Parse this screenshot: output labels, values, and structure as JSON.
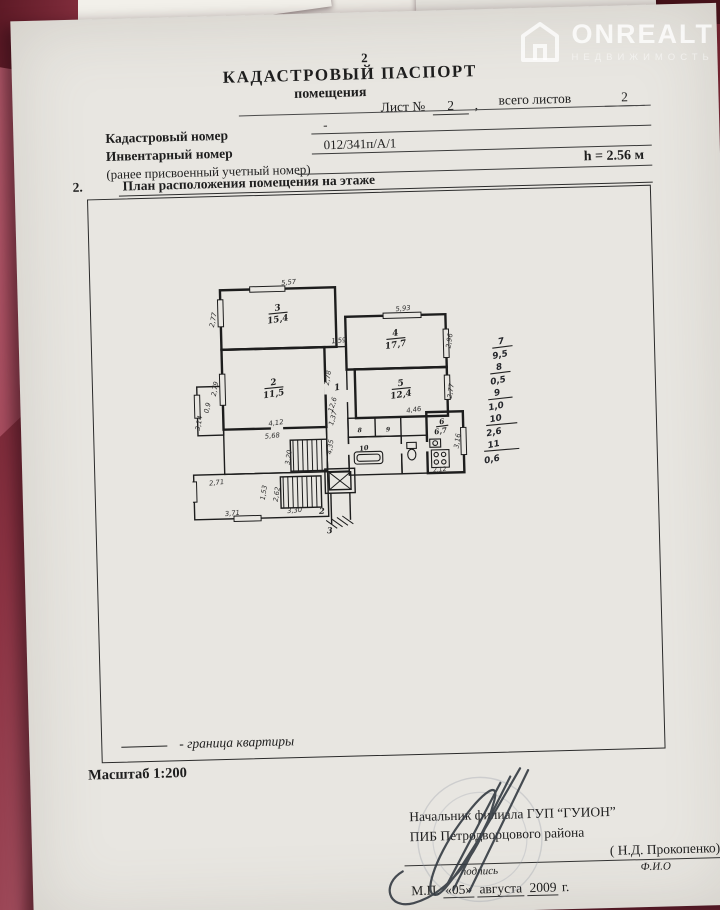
{
  "colors": {
    "background_maroon": "#7c2935",
    "folder_pink": "#a44a5c",
    "paper": "#e8e6e1",
    "ink": "#1e1e1e",
    "watermark_white": "rgba(255,255,255,0.78)"
  },
  "watermark": {
    "brand": "ONREALT",
    "subtitle": "НЕДВИЖИМОСТЬ"
  },
  "header": {
    "page_number": "2",
    "title": "КАДАСТРОВЫЙ ПАСПОРТ",
    "subtitle": "помещения",
    "sheet_label": "Лист №",
    "sheet_value": "2",
    "comma": ",",
    "total_label": "всего листов",
    "total_value": "2"
  },
  "fields": {
    "cadastral_label": "Кадастровый номер",
    "cadastral_value": "-",
    "inventory_label": "Инвентарный номер",
    "inventory_value": "012/341п/А/1",
    "former_label": "(ранее присвоенный учетный номер)",
    "height_value": "h = 2.56 м"
  },
  "section": {
    "number": "2.",
    "title": "План расположения помещения на этаже"
  },
  "plan": {
    "labels": [
      {
        "t": "3",
        "x": 133,
        "y": 50,
        "r": -8,
        "s": 13,
        "c": "room"
      },
      {
        "t": "15,4",
        "x": 133,
        "y": 67,
        "r": -8,
        "s": 13,
        "c": "room"
      },
      {
        "t": "2",
        "x": 124,
        "y": 160,
        "r": -8,
        "s": 13,
        "c": "room"
      },
      {
        "t": "11,5",
        "x": 124,
        "y": 177,
        "r": -8,
        "s": 13,
        "c": "room"
      },
      {
        "t": "4",
        "x": 306,
        "y": 92,
        "r": -8,
        "s": 13,
        "c": "room"
      },
      {
        "t": "17,7",
        "x": 306,
        "y": 109,
        "r": -8,
        "s": 13,
        "c": "room"
      },
      {
        "t": "5",
        "x": 312,
        "y": 166,
        "r": -8,
        "s": 13,
        "c": "room"
      },
      {
        "t": "12,4",
        "x": 312,
        "y": 183,
        "r": -8,
        "s": 13,
        "c": "room"
      },
      {
        "t": "1",
        "x": 218,
        "y": 170,
        "r": -8,
        "s": 13,
        "c": "room"
      },
      {
        "t": "6",
        "x": 371,
        "y": 224,
        "r": -8,
        "s": 11,
        "c": "room"
      },
      {
        "t": "6,7",
        "x": 369,
        "y": 238,
        "r": -8,
        "s": 11,
        "c": "room"
      },
      {
        "t": "8",
        "x": 249,
        "y": 233,
        "r": 0,
        "s": 9,
        "c": "room"
      },
      {
        "t": "9",
        "x": 291,
        "y": 233,
        "r": 0,
        "s": 9,
        "c": "room"
      },
      {
        "t": "10",
        "x": 255,
        "y": 260,
        "r": -8,
        "s": 10,
        "c": "room"
      },
      {
        "t": "2",
        "x": 190,
        "y": 352,
        "r": 0,
        "s": 12,
        "c": "room"
      },
      {
        "t": "3",
        "x": 201,
        "y": 381,
        "r": 0,
        "s": 12,
        "c": "room"
      },
      {
        "t": "5,57",
        "x": 150,
        "y": 12,
        "r": -4,
        "s": 10,
        "c": "dim"
      },
      {
        "t": "2,77",
        "x": 40,
        "y": 62,
        "r": -78,
        "s": 10,
        "c": "dim"
      },
      {
        "t": "2,79",
        "x": 40,
        "y": 164,
        "r": -78,
        "s": 10,
        "c": "dim"
      },
      {
        "t": "4,12",
        "x": 126,
        "y": 219,
        "r": -6,
        "s": 10,
        "c": "dim"
      },
      {
        "t": "1,59",
        "x": 222,
        "y": 100,
        "r": -4,
        "s": 10,
        "c": "dim"
      },
      {
        "t": "2,78",
        "x": 207,
        "y": 152,
        "r": -80,
        "s": 10,
        "c": "dim"
      },
      {
        "t": "5,93",
        "x": 318,
        "y": 55,
        "r": -4,
        "s": 10,
        "c": "dim"
      },
      {
        "t": "2,96",
        "x": 388,
        "y": 102,
        "r": -80,
        "s": 10,
        "c": "dim"
      },
      {
        "t": "4,46",
        "x": 330,
        "y": 205,
        "r": -6,
        "s": 10,
        "c": "dim"
      },
      {
        "t": "2,77",
        "x": 388,
        "y": 176,
        "r": -80,
        "s": 10,
        "c": "dim"
      },
      {
        "t": "12,6",
        "x": 213,
        "y": 192,
        "r": -72,
        "s": 10,
        "c": "dim"
      },
      {
        "t": "1,37",
        "x": 213,
        "y": 212,
        "r": -72,
        "s": 10,
        "c": "dim"
      },
      {
        "t": "4,35",
        "x": 208,
        "y": 254,
        "r": -80,
        "s": 10,
        "c": "dim"
      },
      {
        "t": "5,68",
        "x": 120,
        "y": 238,
        "r": -4,
        "s": 10,
        "c": "dim"
      },
      {
        "t": "3,20",
        "x": 146,
        "y": 268,
        "r": -80,
        "s": 10,
        "c": "dim"
      },
      {
        "t": "0,9",
        "x": 28,
        "y": 192,
        "r": -75,
        "s": 10,
        "c": "dim"
      },
      {
        "t": "3,14",
        "x": 15,
        "y": 214,
        "r": -78,
        "s": 10,
        "c": "dim"
      },
      {
        "t": "2,71",
        "x": 36,
        "y": 305,
        "r": -5,
        "s": 10,
        "c": "dim"
      },
      {
        "t": "1,53",
        "x": 108,
        "y": 319,
        "r": -80,
        "s": 10,
        "c": "dim"
      },
      {
        "t": "2,62",
        "x": 127,
        "y": 322,
        "r": -80,
        "s": 10,
        "c": "dim"
      },
      {
        "t": "3,71",
        "x": 58,
        "y": 351,
        "r": -4,
        "s": 10,
        "c": "dim"
      },
      {
        "t": "3,30",
        "x": 150,
        "y": 349,
        "r": -4,
        "s": 10,
        "c": "dim"
      },
      {
        "t": "2,12",
        "x": 366,
        "y": 294,
        "r": -5,
        "s": 9,
        "c": "dim"
      },
      {
        "t": "3,16",
        "x": 396,
        "y": 250,
        "r": -80,
        "s": 10,
        "c": "dim"
      },
      {
        "t": "7",
        "x": 462,
        "y": 108,
        "r": -10,
        "s": 13,
        "c": "hand"
      },
      {
        "t": "9,5",
        "x": 460,
        "y": 128,
        "r": -10,
        "s": 13,
        "c": "hand"
      },
      {
        "t": "8",
        "x": 458,
        "y": 146,
        "r": -10,
        "s": 13,
        "c": "hand"
      },
      {
        "t": "0,5",
        "x": 456,
        "y": 166,
        "r": -10,
        "s": 13,
        "c": "hand"
      },
      {
        "t": "9",
        "x": 454,
        "y": 184,
        "r": -10,
        "s": 13,
        "c": "hand"
      },
      {
        "t": "1,0",
        "x": 452,
        "y": 204,
        "r": -10,
        "s": 13,
        "c": "hand"
      },
      {
        "t": "10",
        "x": 451,
        "y": 222,
        "r": -10,
        "s": 13,
        "c": "hand"
      },
      {
        "t": "2,6",
        "x": 448,
        "y": 242,
        "r": -10,
        "s": 13,
        "c": "hand"
      },
      {
        "t": "11",
        "x": 447,
        "y": 260,
        "r": -10,
        "s": 13,
        "c": "hand"
      },
      {
        "t": "0,6",
        "x": 444,
        "y": 282,
        "r": -10,
        "s": 13,
        "c": "hand"
      }
    ]
  },
  "legend": {
    "text": "- граница квартиры"
  },
  "scale": {
    "label": "Масштаб  1:200"
  },
  "signature": {
    "line1": "Начальник филиала ГУП “ГУИОН”",
    "line2": "ПИБ Петродворцового района",
    "name": "( Н.Д. Прокопенко)",
    "sign_caption": "подпись",
    "name_caption": "Ф.И.О",
    "date_prefix": "М.П.",
    "date_day": "«05»",
    "date_month": "августа",
    "date_year": "2009",
    "date_suffix": "г."
  }
}
